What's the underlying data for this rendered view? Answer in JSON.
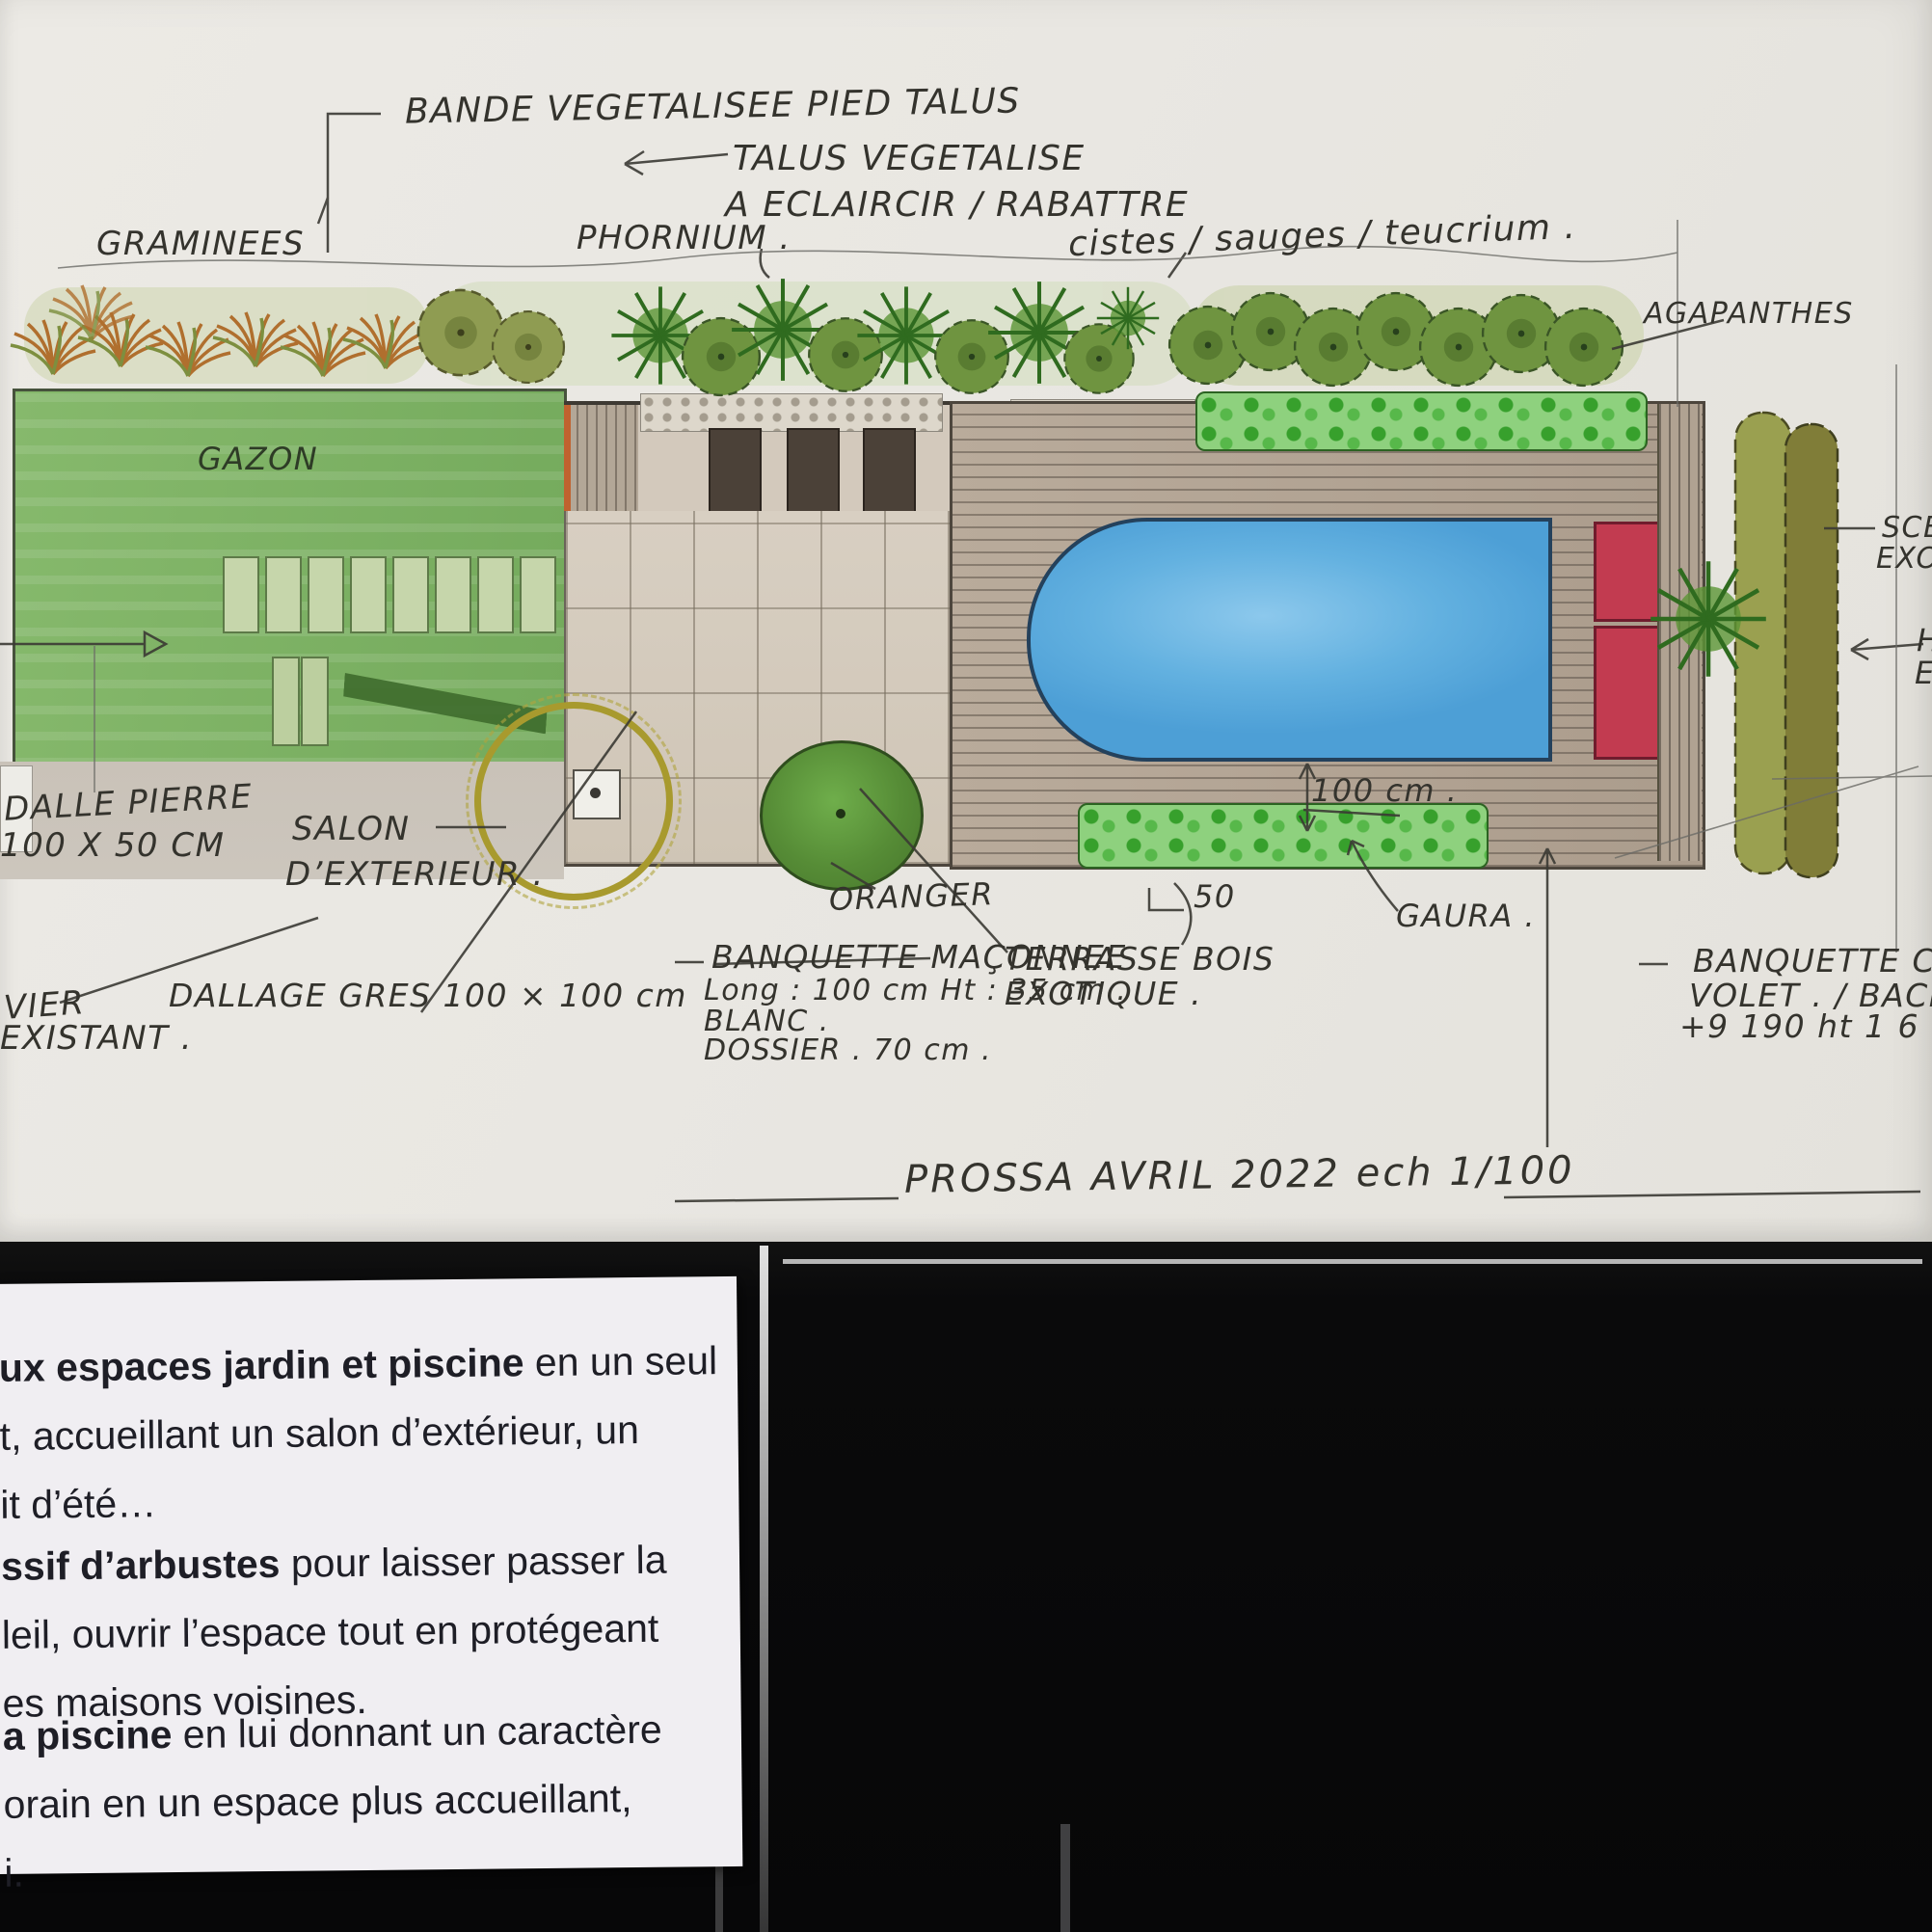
{
  "document_type": "Plan de jardin aquarellé (esquisse paysagiste)",
  "colors": {
    "paper": "#eae8e3",
    "ink": "#34332d",
    "lawn_green": "#80b468",
    "pool_blue": "#58a8dc",
    "accent_red": "#c23b50",
    "hedge_olive": "#97934d",
    "card_white": "#f0eef2",
    "background_black": "#0b0b0c"
  },
  "plan": {
    "annotations": {
      "bande_talus": "BANDE VEGETALISEE PIED TALUS",
      "talus_1": "TALUS VEGETALISE",
      "talus_2": "A ECLAIRCIR / RABATTRE",
      "graminees": "GRAMINEES",
      "phormium": "PHORNIUM .",
      "cistes": "cistes / sauges / teucrium .",
      "agapanthes": "AGAPANTHES",
      "gazon": "GAZON",
      "dalle_pierre_1": "DALLE PIERRE",
      "dalle_pierre_2": "100 X 50 CM",
      "salon_1": "SALON",
      "salon_2": "D’EXTERIEUR .",
      "oranger": "ORANGER",
      "banquette_1": "BANQUETTE MAÇONNEE",
      "banquette_2": "Long : 100 cm   Ht : 35 cm .",
      "banquette_3": "BLANC .",
      "banquette_4": "DOSSIER . 70 cm .",
      "terrasse_1": "TERRASSE BOIS",
      "terrasse_2": "EXOTIQUE .",
      "dallage": "DALLAGE GRES 100 × 100 cm",
      "olivier_1": "VIER",
      "olivier_2": "EXISTANT .",
      "gaura": "GAURA .",
      "dim_100": "100 cm .",
      "dim_50": "50",
      "banquette_coffre_1": "BANQUETTE COF",
      "banquette_coffre_2": "VOLET . / BACH",
      "banquette_coffre_3": "+9 190 ht 1 6",
      "scene_1": "SCEN",
      "scene_2": "EXO",
      "haie_1": "H",
      "haie_2": "E",
      "title": "PROSSA  AVRIL 2022   ech 1/100"
    }
  },
  "caption_card": {
    "paragraphs": [
      [
        {
          "bold": "ux espaces jardin et piscine",
          "text": " en un seul"
        },
        {
          "bold": "",
          "text": "t, accueillant un salon d’extérieur, un"
        },
        {
          "bold": "",
          "text": "it d’été…"
        }
      ],
      [
        {
          "bold": "ssif d’arbustes",
          "text": " pour laisser passer la"
        },
        {
          "bold": "",
          "text": "leil, ouvrir l’espace tout en protégeant"
        },
        {
          "bold": "",
          "text": "es maisons voisines."
        }
      ],
      [
        {
          "bold": "a piscine",
          "text": " en lui donnant un caractère"
        },
        {
          "bold": "",
          "text": "orain en un espace plus accueillant,"
        },
        {
          "bold": "",
          "text": "i."
        }
      ]
    ]
  }
}
